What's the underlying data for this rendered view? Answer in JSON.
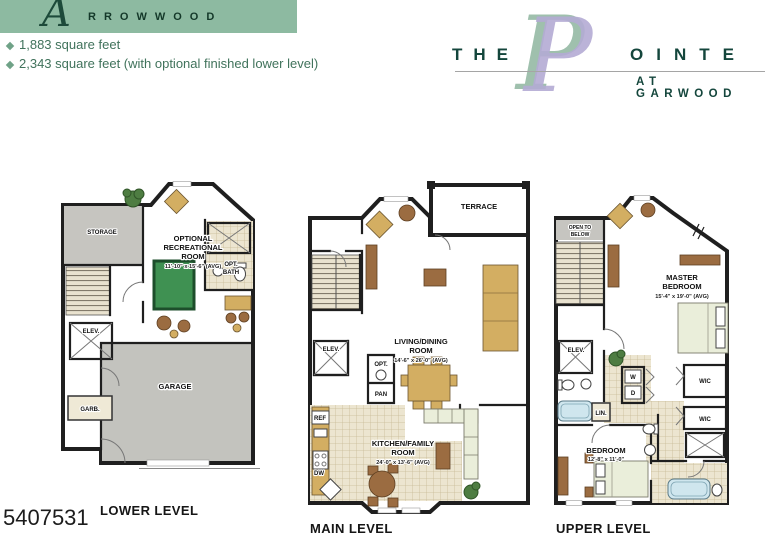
{
  "header": {
    "banner": {
      "initial": "A",
      "name": "RROWWOOD"
    },
    "features": [
      "1,883 square feet",
      "2,343 square feet (with optional finished lower level)"
    ],
    "bullet_icon": "diamond"
  },
  "logo": {
    "the": "THE",
    "initial": "P",
    "rest": "OINTE",
    "subtitle": "AT GARWOOD"
  },
  "photo_id": "5407531",
  "plans": {
    "lower": {
      "label": "LOWER LEVEL",
      "rooms": {
        "storage": "STORAGE",
        "rec1": "OPTIONAL",
        "rec2": "RECREATIONAL",
        "rec3": "ROOM",
        "rec_dim": "11'-10\" x 15'-6\" (AVG)",
        "opt_bath1": "OPT.",
        "opt_bath2": "BATH",
        "elev": "ELEV.",
        "garage": "GARAGE",
        "garb": "GARB."
      }
    },
    "main": {
      "label": "MAIN LEVEL",
      "rooms": {
        "terrace": "TERRACE",
        "living1": "LIVING/DINING",
        "living2": "ROOM",
        "living_dim": "14'-6\" x 26'-0\" (AVG)",
        "elev": "ELEV.",
        "opt": "OPT.",
        "pan": "PAN",
        "ref": "REF",
        "kitchen1": "KITCHEN/FAMILY",
        "kitchen2": "ROOM",
        "kitchen_dim": "24'-0\" x 13'-6\" (AVG)",
        "dw": "DW"
      }
    },
    "upper": {
      "label": "UPPER LEVEL",
      "rooms": {
        "open1": "OPEN TO",
        "open2": "BELOW",
        "master1": "MASTER",
        "master2": "BEDROOM",
        "master_dim": "15'-4\" x 19'-0\" (AVG)",
        "elev": "ELEV.",
        "washer": "W",
        "dryer": "D",
        "lin": "LIN.",
        "wic_top": "WIC",
        "wic_bottom": "WIC",
        "bedroom": "BEDROOM",
        "bedroom_dim": "12'-8\" x 11'-0\""
      }
    }
  },
  "colors": {
    "banner_green": "#8dbaa1",
    "brand_dark_green": "#14463c",
    "logo_sage": "#9fc0ad",
    "logo_lavender": "#b4abd4",
    "wall": "#1f1f1f",
    "carpet_beige": "#ded6c0",
    "garage_gray": "#c3c3be",
    "pool_table_green": "#3f9152",
    "tub_blue": "#cfe6ee"
  }
}
